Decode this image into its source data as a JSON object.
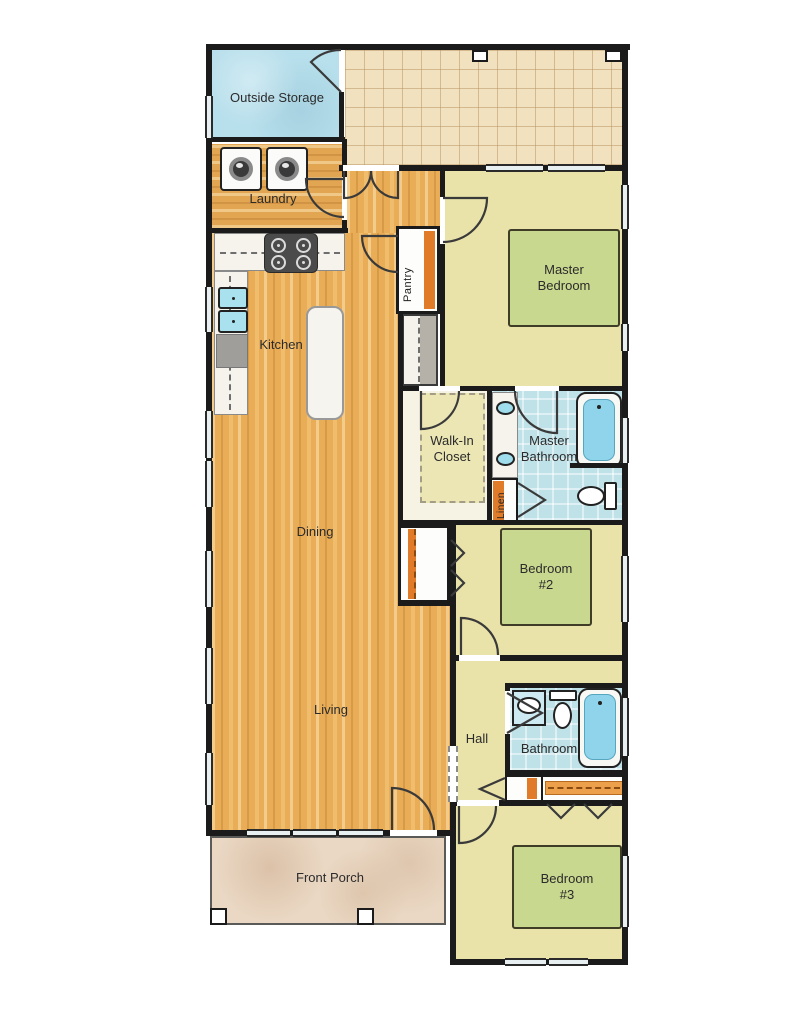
{
  "plan": {
    "title": "Single-story house floor plan",
    "rooms": {
      "outside_storage": "Outside Storage",
      "laundry": "Laundry",
      "kitchen": "Kitchen",
      "pantry": "Pantry",
      "master_bedroom": "Master Bedroom",
      "walk_in_closet": "Walk-In Closet",
      "master_bathroom": "Master Bathroom",
      "linen": "Linen",
      "dining": "Dining",
      "bedroom2": "Bedroom #2",
      "living": "Living",
      "hall": "Hall",
      "bathroom": "Bathroom",
      "bedroom3": "Bedroom #3",
      "front_porch": "Front Porch"
    },
    "fixtures": [
      "washer-icon",
      "dryer-icon",
      "stove-icon",
      "kitchen-sink-icon",
      "refrigerator-icon",
      "island-icon",
      "bed-icon",
      "vanity-sink-icon",
      "bathtub-icon",
      "toilet-icon",
      "door-arc-icon",
      "bifold-door-icon",
      "window-icon",
      "porch-post-icon",
      "shelf-icon"
    ],
    "colors": {
      "wall": "#1b1b1b",
      "wood_floor": "#e9ad57",
      "room_yellow": "#e9e3aa",
      "bed_green": "#c8d88e",
      "tile_blue": "#bfe1e8",
      "storage_blue": "#b7dfec",
      "patio_tan": "#f2e1bf",
      "porch_stone": "#ead8c4",
      "shelf_orange": "#e07b2a"
    }
  }
}
